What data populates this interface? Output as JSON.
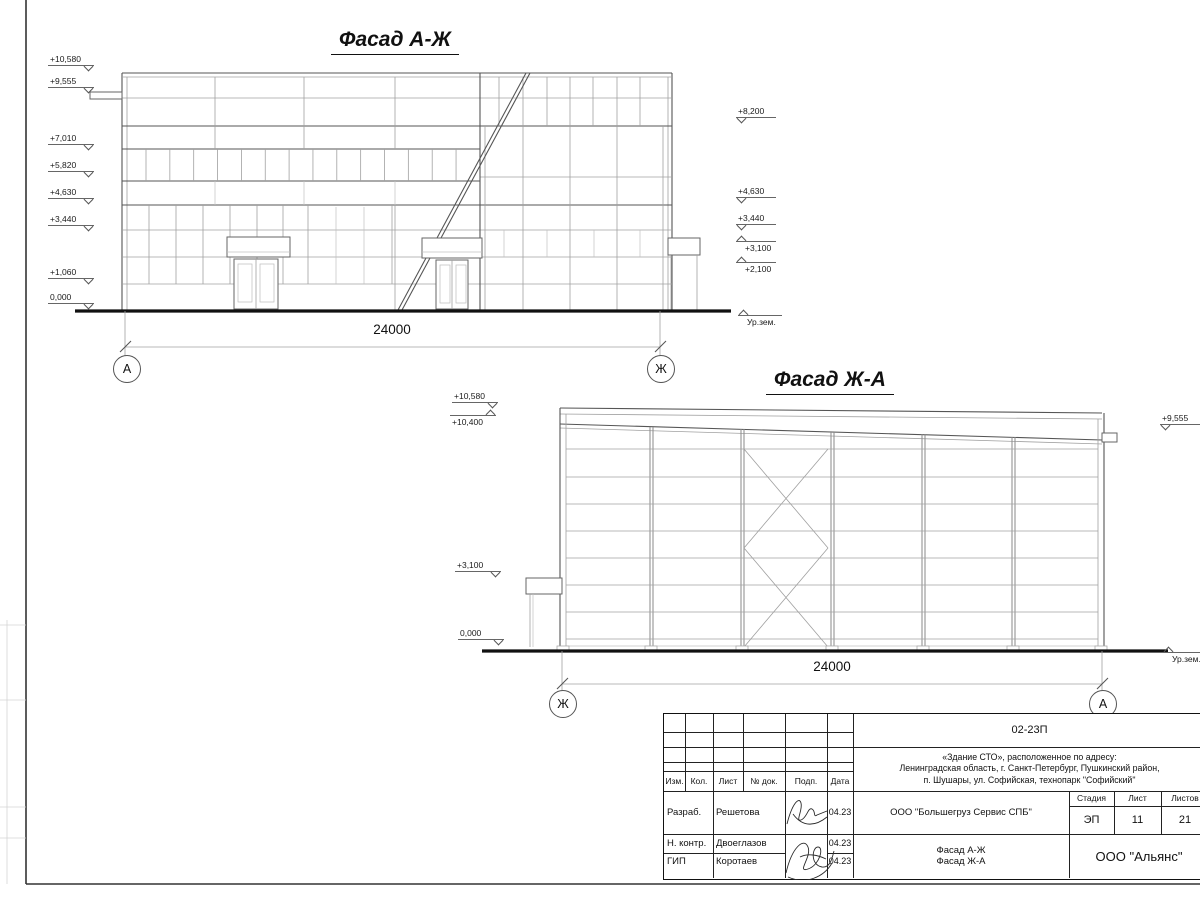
{
  "facade1": {
    "title": "Фасад А-Ж",
    "marks_left": [
      "+10,580",
      "+9,555",
      "+7,010",
      "+5,820",
      "+4,630",
      "+3,440",
      "+1,060",
      "0,000"
    ],
    "marks_right": [
      "+8,200",
      "+4,630",
      "+3,440",
      "+3,100",
      "+2,100"
    ],
    "ground_label": "Ур.зем.",
    "dimension": "24000",
    "axis_left": "А",
    "axis_right": "Ж"
  },
  "facade2": {
    "title": "Фасад Ж-А",
    "marks_left": [
      "+10,580",
      "+10,400",
      "+3,100",
      "0,000"
    ],
    "marks_right": [
      "+9,555"
    ],
    "ground_label": "Ур.зем.",
    "dimension": "24000",
    "axis_left": "Ж",
    "axis_right": "А"
  },
  "titleblock": {
    "code": "02-23П",
    "address": [
      "«Здание СТО», расположенное по адресу:",
      "Ленинградская область, г. Санкт-Петербург, Пушкинский район,",
      "п. Шушары, ул. Софийская, технопарк \"Софийский\""
    ],
    "headers": {
      "izm": "Изм.",
      "kol": "Кол.",
      "list": "Лист",
      "doc": "№ док.",
      "podp": "Подп.",
      "data": "Дата"
    },
    "rows": [
      {
        "role": "Разраб.",
        "name": "Решетова",
        "date": "04.23"
      },
      {
        "role": "Н. контр.",
        "name": "Двоеглазов",
        "date": "04.23"
      },
      {
        "role": "ГИП",
        "name": "Коротаев",
        "date": "04.23"
      }
    ],
    "org": "ООО \"Большегруз Сервис СПБ\"",
    "stage_label": "Стадия",
    "sheet_label": "Лист",
    "sheets_label": "Листов",
    "stage": "ЭП",
    "sheet_no": "11",
    "sheets_total": "21",
    "doc_name": [
      "Фасад А-Ж",
      "Фасад Ж-А"
    ],
    "company": "ООО \"Альянс\""
  }
}
